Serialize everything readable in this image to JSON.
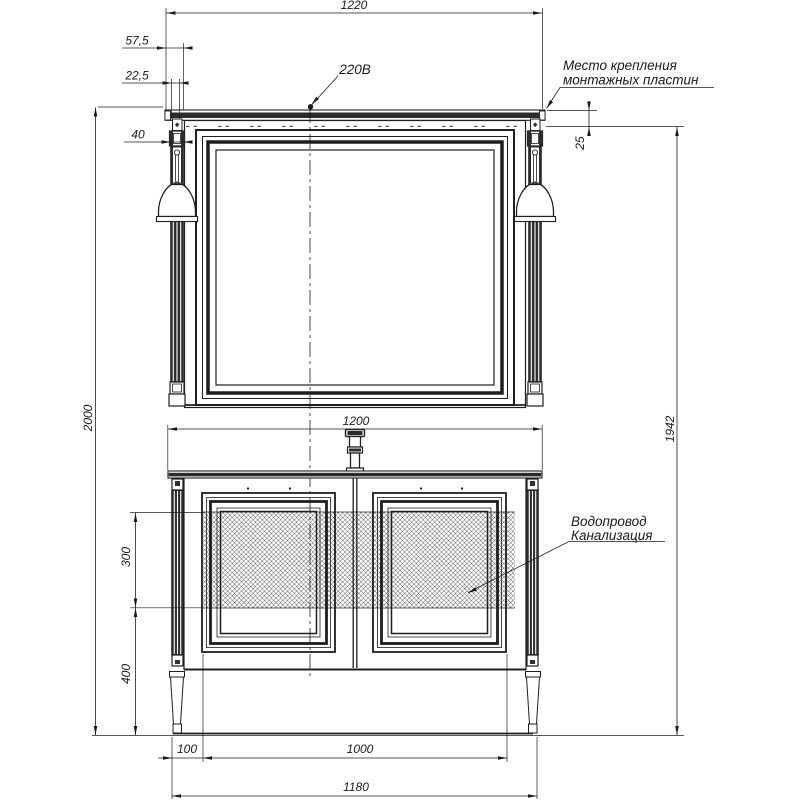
{
  "drawing": {
    "dimensions": {
      "top_width": "1220",
      "cornice_offset": "57,5",
      "lamp_offset": "22,5",
      "column_width": "40",
      "total_height": "2000",
      "mount_height": "1942",
      "plate_offset": "25",
      "vanity_width": "1200",
      "utility_zone_height": "300",
      "utility_zone_bottom": "400",
      "leg_inset": "100",
      "door_span": "1000",
      "base_width": "1180"
    },
    "labels": {
      "power": "220В",
      "mounting_line1": "Место крепления",
      "mounting_line2": "монтажных пластин",
      "water_line1": "Водопровод",
      "water_line2": "Канализация"
    },
    "colors": {
      "line": "#1f1f1f",
      "dark_fill": "#2b2b2b",
      "background": "#ffffff"
    }
  }
}
